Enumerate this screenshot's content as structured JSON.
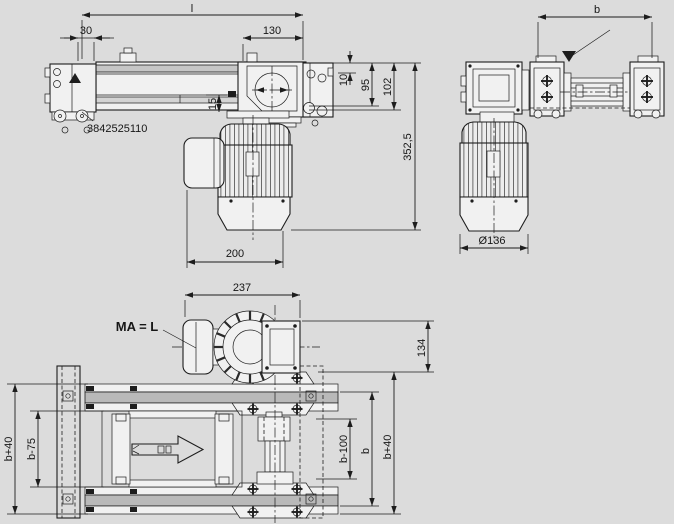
{
  "title": "Conveyor drive unit technical drawing",
  "colors": {
    "background": "#dcdcdc",
    "line": "#1d1d1d",
    "fill_light": "#f1f1f1",
    "fill_gray": "#b9b9b9"
  },
  "front_view": {
    "part_number": "3842525110",
    "dim_length": "l",
    "dim_left_offset": "30",
    "dim_head_width": "130",
    "dim_top_inset": "10",
    "dim_height_95": "95",
    "dim_height_102": "102",
    "dim_gap_15": "15",
    "dim_overall_height": "352,5",
    "dim_motor_width": "200"
  },
  "end_view": {
    "dim_width": "b",
    "dim_motor_diameter": "Ø136"
  },
  "plan_view": {
    "dim_motor_length": "237",
    "dim_motor_offset": "134",
    "torque_note": "MA = L",
    "dim_outer_left": "b+40",
    "dim_inner_left": "b-75",
    "dim_inner_right": "b-100",
    "dim_track_right": "b",
    "dim_outer_right": "b+40"
  }
}
